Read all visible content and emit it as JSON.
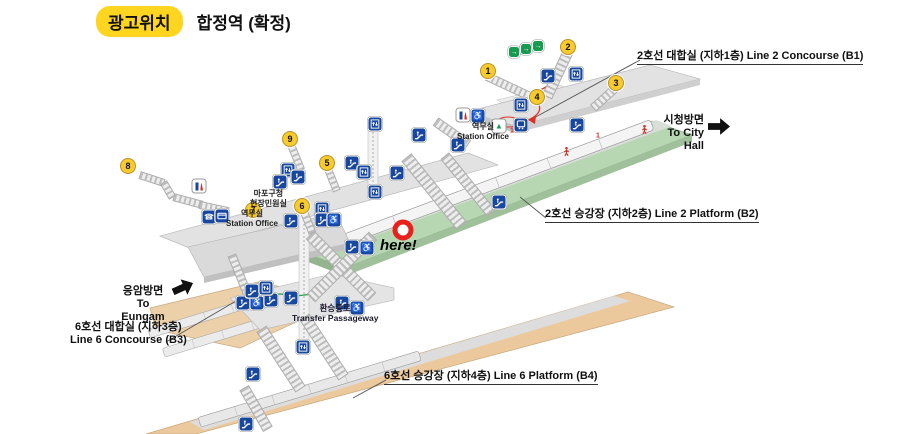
{
  "header": {
    "badge": "광고위치",
    "title": "합정역 (확정)"
  },
  "colors": {
    "badge_yellow": "#ffd520",
    "line2_platform_green": "#b7d7b2",
    "line6_platform_tan": "#ecc99d",
    "icon_blue": "#17479e",
    "exit_green": "#169b4f",
    "marker_yellow": "#f7ca2d",
    "here_red": "#e8211d"
  },
  "directions": {
    "city_hall": {
      "ko": "시청방면",
      "en": "To City Hall"
    },
    "eungam": {
      "ko": "응암방면",
      "en": "To Eungam"
    }
  },
  "here": {
    "text": "here!"
  },
  "map": {
    "labels": [
      {
        "id": "line2-concourse",
        "x": 637,
        "y": 47,
        "lines": [
          "2호선 대합실 (지하1층) Line 2 Concourse (B1)"
        ]
      },
      {
        "id": "line2-platform",
        "x": 545,
        "y": 205,
        "lines": [
          "2호선 승강장 (지하2층) Line 2 Platform (B2)"
        ]
      },
      {
        "id": "line6-platform",
        "x": 384,
        "y": 367,
        "lines": [
          "6호선 승강장 (지하4층) Line 6 Platform (B4)"
        ]
      },
      {
        "id": "line6-concourse",
        "x": 70,
        "y": 321,
        "lines": [
          "6호선 대합실 (지하3층)",
          "Line 6 Concourse (B3)"
        ]
      },
      {
        "id": "transfer",
        "x": 292,
        "y": 303,
        "lines": [
          "환승통로",
          "Transfer Passageway"
        ]
      },
      {
        "id": "station-office-b1",
        "x": 457,
        "y": 122,
        "lines": [
          "역무실",
          "Station Office"
        ]
      },
      {
        "id": "station-office-mezz",
        "x": 226,
        "y": 209,
        "lines": [
          "역무실",
          "Station Office"
        ]
      },
      {
        "id": "mapo",
        "x": 250,
        "y": 189,
        "lines": [
          "마포구청",
          "현장민원실"
        ]
      }
    ],
    "markers": [
      {
        "n": "1",
        "x": 488,
        "y": 71
      },
      {
        "n": "2",
        "x": 568,
        "y": 47
      },
      {
        "n": "3",
        "x": 616,
        "y": 83
      },
      {
        "n": "4",
        "x": 537,
        "y": 97
      },
      {
        "n": "5",
        "x": 327,
        "y": 163
      },
      {
        "n": "6",
        "x": 302,
        "y": 206
      },
      {
        "n": "7",
        "x": 253,
        "y": 210
      },
      {
        "n": "8",
        "x": 128,
        "y": 166
      },
      {
        "n": "9",
        "x": 290,
        "y": 139
      }
    ],
    "icons": [
      {
        "t": "exit",
        "x": 514,
        "y": 52
      },
      {
        "t": "exit",
        "x": 526,
        "y": 49
      },
      {
        "t": "exit",
        "x": 538,
        "y": 46
      },
      {
        "t": "escalator",
        "x": 548,
        "y": 76
      },
      {
        "t": "elevator",
        "x": 576,
        "y": 74
      },
      {
        "t": "restroom",
        "x": 463,
        "y": 115
      },
      {
        "t": "wheelchair",
        "x": 478,
        "y": 116
      },
      {
        "t": "shelter",
        "x": 499,
        "y": 126
      },
      {
        "t": "train-sign",
        "x": 521,
        "y": 125
      },
      {
        "t": "elevator",
        "x": 521,
        "y": 105
      },
      {
        "t": "escalator",
        "x": 458,
        "y": 145
      },
      {
        "t": "escalator",
        "x": 577,
        "y": 125
      },
      {
        "t": "elevator",
        "x": 375,
        "y": 124
      },
      {
        "t": "elevator",
        "x": 375,
        "y": 192
      },
      {
        "t": "restroom",
        "x": 199,
        "y": 186
      },
      {
        "t": "phone",
        "x": 209,
        "y": 217
      },
      {
        "t": "card",
        "x": 222,
        "y": 216
      },
      {
        "t": "elevator",
        "x": 288,
        "y": 170
      },
      {
        "t": "escalator",
        "x": 280,
        "y": 182
      },
      {
        "t": "escalator",
        "x": 298,
        "y": 177
      },
      {
        "t": "escalator",
        "x": 352,
        "y": 163
      },
      {
        "t": "elevator",
        "x": 364,
        "y": 172
      },
      {
        "t": "escalator",
        "x": 397,
        "y": 173
      },
      {
        "t": "escalator",
        "x": 419,
        "y": 135
      },
      {
        "t": "elevator",
        "x": 322,
        "y": 209
      },
      {
        "t": "escalator",
        "x": 322,
        "y": 220
      },
      {
        "t": "wheelchair",
        "x": 334,
        "y": 220
      },
      {
        "t": "escalator",
        "x": 291,
        "y": 221
      },
      {
        "t": "escalator",
        "x": 352,
        "y": 247
      },
      {
        "t": "wheelchair",
        "x": 367,
        "y": 248
      },
      {
        "t": "escalator",
        "x": 499,
        "y": 202
      },
      {
        "t": "escalator",
        "x": 243,
        "y": 303
      },
      {
        "t": "wheelchair",
        "x": 257,
        "y": 303
      },
      {
        "t": "escalator",
        "x": 271,
        "y": 300
      },
      {
        "t": "escalator",
        "x": 291,
        "y": 298
      },
      {
        "t": "escalator",
        "x": 252,
        "y": 291
      },
      {
        "t": "elevator",
        "x": 266,
        "y": 288
      },
      {
        "t": "escalator",
        "x": 342,
        "y": 303
      },
      {
        "t": "wheelchair",
        "x": 357,
        "y": 308
      },
      {
        "t": "elevator",
        "x": 303,
        "y": 347
      },
      {
        "t": "escalator",
        "x": 253,
        "y": 374
      },
      {
        "t": "escalator",
        "x": 246,
        "y": 424
      },
      {
        "t": "red-person",
        "x": 566,
        "y": 151
      },
      {
        "t": "red-person",
        "x": 644,
        "y": 129
      },
      {
        "t": "red-sign",
        "x": 512,
        "y": 131
      },
      {
        "t": "red-sign",
        "x": 598,
        "y": 136
      }
    ],
    "stairs": [
      {
        "cx": 558,
        "cy": 73,
        "len": 52,
        "w": 11,
        "a": 115
      },
      {
        "cx": 513,
        "cy": 88,
        "len": 58,
        "w": 9,
        "a": 25
      },
      {
        "cx": 605,
        "cy": 97,
        "len": 32,
        "w": 9,
        "a": 138
      },
      {
        "cx": 434,
        "cy": 191,
        "len": 88,
        "w": 13,
        "a": 51
      },
      {
        "cx": 468,
        "cy": 184,
        "len": 74,
        "w": 11,
        "a": 51
      },
      {
        "cx": 452,
        "cy": 133,
        "len": 40,
        "w": 10,
        "a": 35
      },
      {
        "cx": 341,
        "cy": 266,
        "len": 88,
        "w": 12,
        "a": 45
      },
      {
        "cx": 342,
        "cy": 267,
        "len": 88,
        "w": 12,
        "a": 135
      },
      {
        "cx": 152,
        "cy": 179,
        "len": 26,
        "w": 8,
        "a": 18
      },
      {
        "cx": 168,
        "cy": 190,
        "len": 18,
        "w": 8,
        "a": 60
      },
      {
        "cx": 188,
        "cy": 201,
        "len": 30,
        "w": 8,
        "a": 15
      },
      {
        "cx": 214,
        "cy": 208,
        "len": 30,
        "w": 8,
        "a": 12
      },
      {
        "cx": 281,
        "cy": 359,
        "len": 72,
        "w": 12,
        "a": 57
      },
      {
        "cx": 324,
        "cy": 347,
        "len": 72,
        "w": 12,
        "a": 57
      },
      {
        "cx": 256,
        "cy": 408,
        "len": 48,
        "w": 11,
        "a": 60
      },
      {
        "cx": 296,
        "cy": 157,
        "len": 28,
        "w": 8,
        "a": 68
      },
      {
        "cx": 332,
        "cy": 179,
        "len": 26,
        "w": 8,
        "a": 68
      },
      {
        "cx": 308,
        "cy": 222,
        "len": 24,
        "w": 8,
        "a": 68
      },
      {
        "cx": 240,
        "cy": 275,
        "len": 44,
        "w": 9,
        "a": 68
      }
    ]
  }
}
